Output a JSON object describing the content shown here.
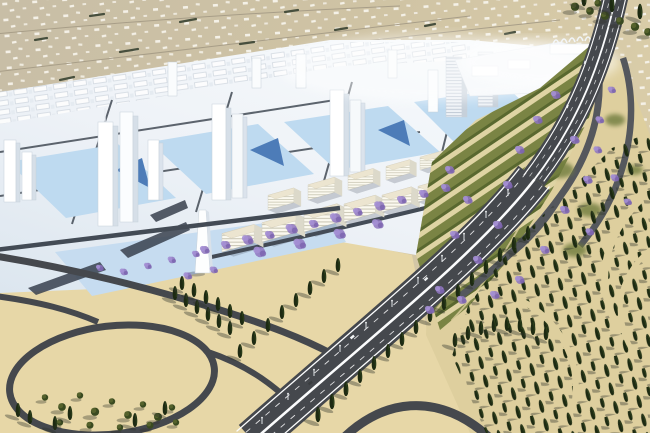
{
  "scene": {
    "type": "3d-architectural-rendering",
    "subject": "aerial bird's-eye rendering of a desert urban masterplan",
    "regions": {
      "top": "existing low-rise settlement on tan hillside",
      "left": "white massing model of new city with towers and blue plazas",
      "center": "rows of cream mid-rise blocks along a boulevard with purple flowering trees",
      "right": "terraced striped gardens, highway interchange ramps",
      "bottom_right": "rows of dark cypress forest on sand",
      "bottom_left": "sand with elliptical loop road enclosing a tree grove",
      "diagonal": "multi-lane highway with bright median crossing to bottom edge"
    }
  },
  "colors": {
    "hill_left": "#c9bfa6",
    "hill_right": "#d7caa7",
    "hill_road": "#a89e88",
    "hedge": "#474f3d",
    "sand": "#e7d7a7",
    "sand_right": "#decf9e",
    "city_white": "#eef2f7",
    "tower_face": "#ffffff",
    "tower_side": "#d6dfe8",
    "plaza_blue": "#bedaf0",
    "plaza_accent": "#4d7cb8",
    "street": "#434b55",
    "block_top": "#ece5d0",
    "block_front": "#fbf9ef",
    "block_side": "#dcd9ca",
    "terrace_olive": "#7a8444",
    "terrace_dark": "#59682f",
    "terrace_cream": "#dfd4a4",
    "asphalt": "#45484d",
    "asphalt_light": "#55585d",
    "road_line": "#fbfcfd",
    "cypress": "#1d2a12",
    "cypress_light": "#33491f",
    "tree_olive": "#3a4a20",
    "jacaranda": "#8e76c0",
    "shadow": "rgba(45,50,42,0.38)"
  }
}
